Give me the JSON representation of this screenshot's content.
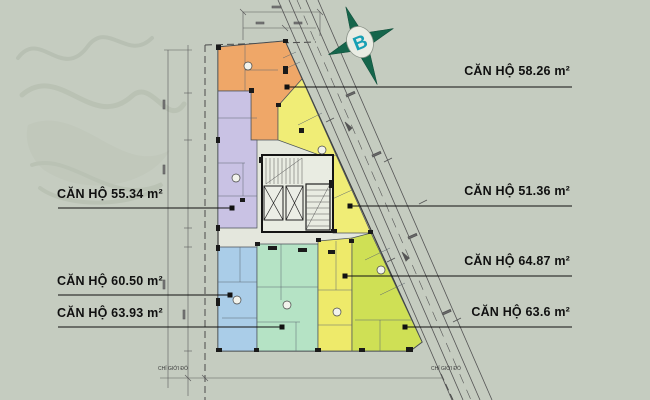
{
  "plan": {
    "compass_letter": "B",
    "units": [
      {
        "id": "58-26",
        "label": "CĂN HỘ 58.26 m²",
        "area_m2": "58.26",
        "color": "#efa768"
      },
      {
        "id": "55-34",
        "label": "CĂN HỘ 55.34 m²",
        "area_m2": "55.34",
        "color": "#c9c2e4"
      },
      {
        "id": "51-36",
        "label": "CĂN HỘ 51.36 m²",
        "area_m2": "51.36",
        "color": "#f0ed76"
      },
      {
        "id": "60-50",
        "label": "CĂN HỘ 60.50 m²",
        "area_m2": "60.50",
        "color": "#aacde8"
      },
      {
        "id": "63-93",
        "label": "CĂN HỘ 63.93 m²",
        "area_m2": "63.93",
        "color": "#b5e3c5"
      },
      {
        "id": "64-87",
        "label": "CĂN HỘ 64.87 m²",
        "area_m2": "64.87",
        "color": "#eeea6a"
      },
      {
        "id": "63-6",
        "label": "CĂN HỘ 63.6 m²",
        "area_m2": "63.6",
        "color": "#cfe055"
      }
    ],
    "boundary_label_left": "CHỈ GIỚI ĐỎ",
    "boundary_label_right": "CHỈ GIỚI ĐỎ",
    "colors": {
      "background": "#c5ccc0",
      "building_base": "#e4e7dd",
      "walls": "#3c3c3c",
      "compass_star": "#15654b",
      "compass_letter": "#18a0b4",
      "leader_line": "#111111"
    }
  }
}
